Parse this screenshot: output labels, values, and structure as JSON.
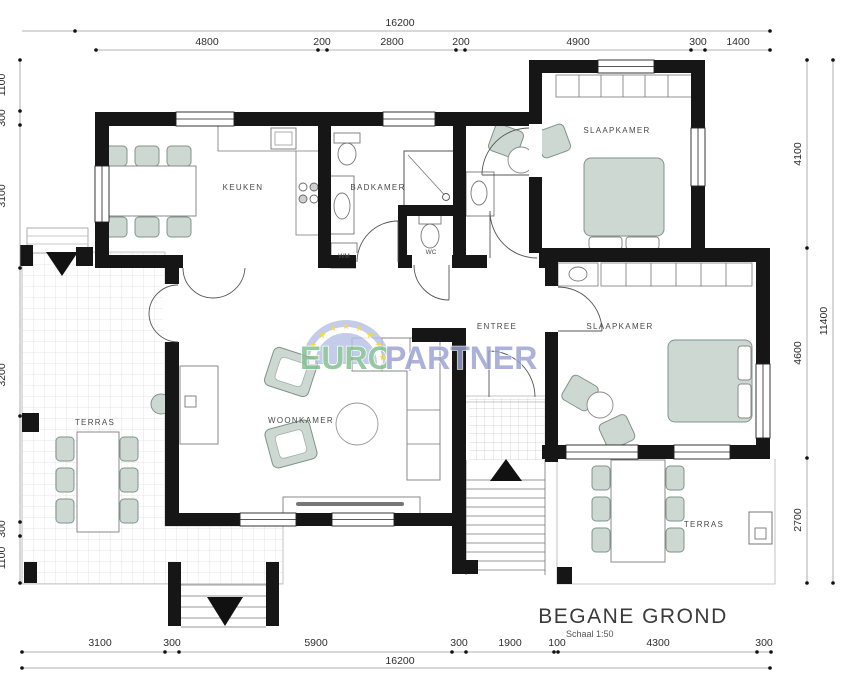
{
  "document": {
    "title": "BEGANE GROND",
    "scale_note": "Schaal 1:50"
  },
  "watermark": {
    "text_green": "EURO",
    "text_blue": "PARTNER",
    "emblem": "eu-stars-semicircle"
  },
  "rooms": {
    "keuken": "KEUKEN",
    "badkamer": "BADKAMER",
    "wm": "WM",
    "wc": "WC",
    "entree": "ENTREE",
    "woonkamer": "WOONKAMER",
    "slaapkamer_top": "SLAAPKAMER",
    "slaapkamer_bottom": "SLAAPKAMER",
    "terras_left": "TERRAS",
    "terras_right": "TERRAS"
  },
  "dimensions_mm": {
    "top_total": "16200",
    "top_chain": [
      "4800",
      "200",
      "2800",
      "200",
      "4900",
      "300",
      "1400"
    ],
    "bottom_chain": [
      "3100",
      "300",
      "5900",
      "300",
      "1900",
      "100",
      "4300",
      "300"
    ],
    "bottom_total": "16200",
    "left_chain": [
      "1100",
      "300",
      "3100",
      "3200",
      "300",
      "1100"
    ],
    "right_chain": [
      "4100",
      "4600",
      "2700"
    ],
    "right_total": "11400"
  },
  "colors": {
    "wall": "#161616",
    "furniture_fill": "#cdd8d2",
    "furniture_stroke": "#7e948b",
    "dimension_line": "#9a9a9a",
    "text": "#3a3a3a",
    "tile_line": "#dcdcdc",
    "watermark_green": "#7fbe8e",
    "watermark_blue": "#99a1d0",
    "eu_circle_blue": "#b6c1e4",
    "star_yellow": "#f0d11e"
  }
}
